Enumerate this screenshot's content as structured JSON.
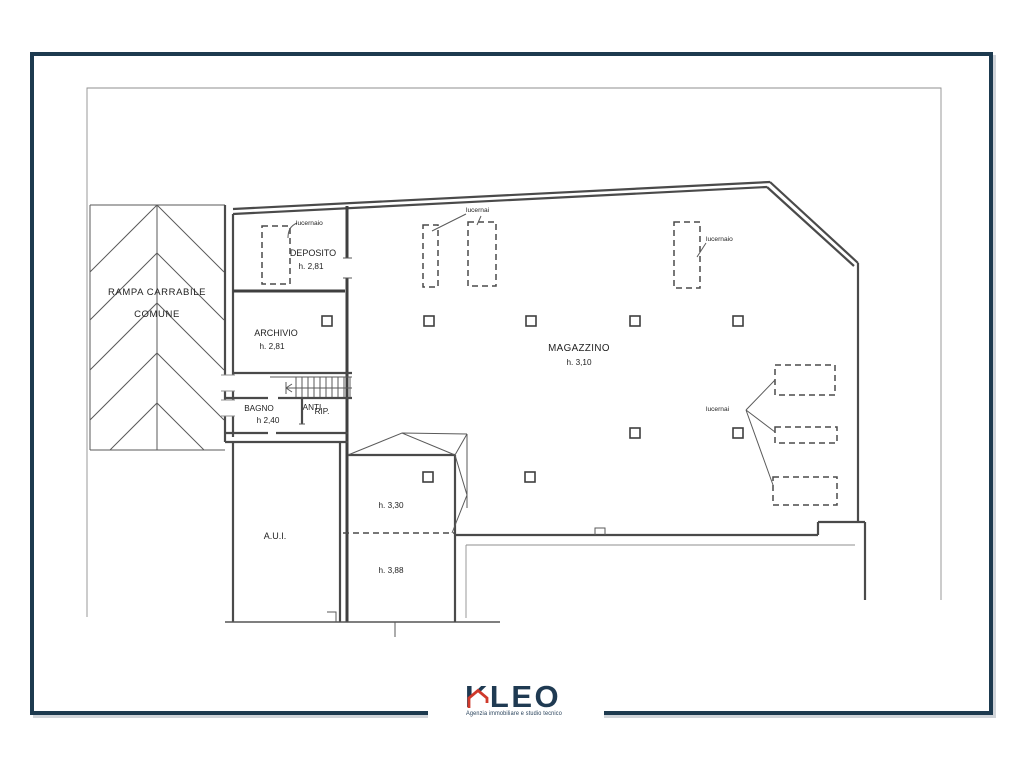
{
  "colors": {
    "frame_navy": "#1d3a4f",
    "plan_line_gray": "#4a4a4a",
    "logo_navy": "#1f3a52",
    "logo_red": "#cf392b"
  },
  "plan": {
    "ramp": {
      "line1": "RAMPA CARRABILE",
      "line2": "COMUNE"
    },
    "rooms": {
      "deposito": {
        "name": "DEPOSITO",
        "height": "h. 2,81"
      },
      "archivio": {
        "name": "ARCHIVIO",
        "height": "h. 2,81"
      },
      "bagno": {
        "name": "BAGNO",
        "height": "h 2,40"
      },
      "anti": {
        "name": "ANTI"
      },
      "rip": {
        "name": "RIP."
      },
      "magazzino": {
        "name": "MAGAZZINO",
        "height": "h. 3,10"
      },
      "aui": {
        "name": "A.U.I."
      },
      "vano330": {
        "height": "h. 3,30"
      },
      "vano388": {
        "height": "h. 3,88"
      }
    },
    "skylights": {
      "single": "lucernaio",
      "plural": "lucernai"
    }
  },
  "logo": {
    "name": "KLEO",
    "tagline": "Agenzia immobiliare e studio tecnico"
  }
}
